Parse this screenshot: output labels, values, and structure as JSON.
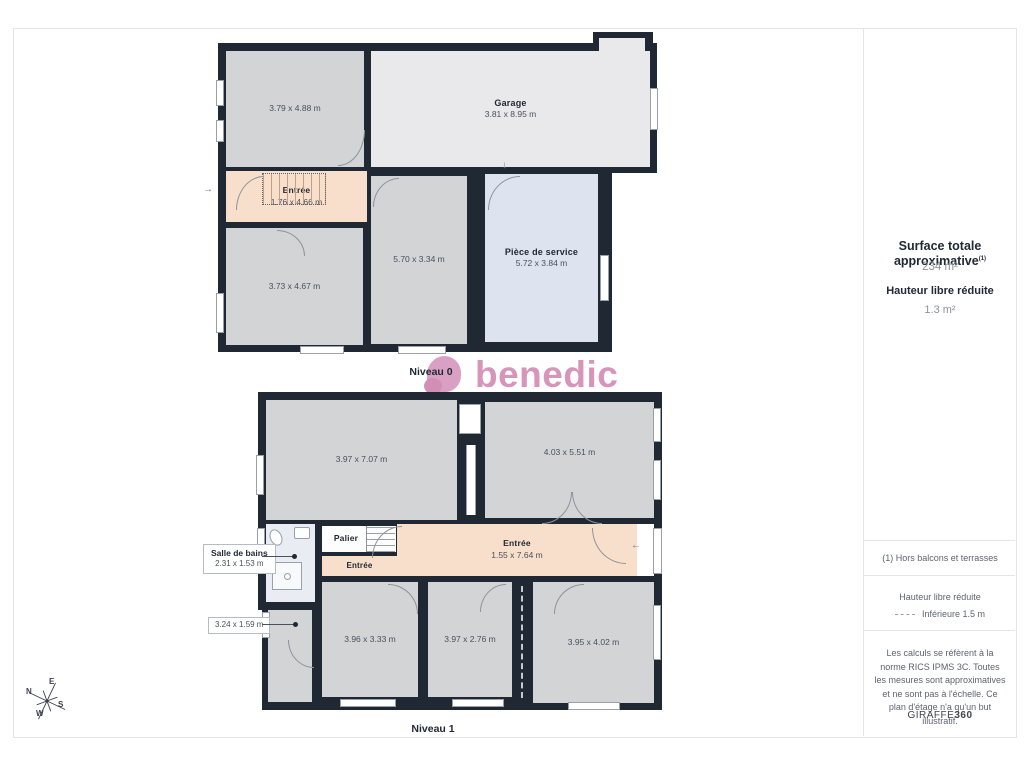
{
  "plans": {
    "niveau0": {
      "title": "Niveau 0",
      "rooms": [
        {
          "dims": "3.79 x 4.88 m"
        },
        {
          "name": "Garage",
          "dims": "3.81 x 8.95 m"
        },
        {
          "name": "Entrée",
          "dims": "1.76 x 4.66 m"
        },
        {
          "dims": "3.73 x 4.67 m"
        },
        {
          "dims": "5.70 x 3.34 m"
        },
        {
          "name": "Pièce de service",
          "dims": "5.72 x 3.84 m"
        }
      ]
    },
    "niveau1": {
      "title": "Niveau 1",
      "rooms": [
        {
          "dims": "3.97 x 7.07 m"
        },
        {
          "dims": "4.03 x 5.51 m"
        },
        {
          "name": "Palier"
        },
        {
          "name": "Entrée"
        },
        {
          "name": "Entrée",
          "dims": "1.55 x 7.64 m"
        },
        {
          "dims": "3.96 x 3.33 m"
        },
        {
          "dims": "3.97 x 2.76 m"
        },
        {
          "dims": "3.95 x 4.02 m"
        }
      ],
      "callouts": [
        {
          "name": "Salle de bains",
          "dims": "2.31 x 1.53 m"
        },
        {
          "dims": "3.24 x 1.59 m"
        }
      ]
    }
  },
  "logo": {
    "text": "benedic"
  },
  "compass": {
    "n": "N",
    "e": "E",
    "s": "S",
    "w": "W"
  },
  "icons": {
    "arrow_right": "→",
    "arrow_down": "↓",
    "arrow_left": "←"
  },
  "sidebar": {
    "surface_title": "Surface totale approximative",
    "surface_sup": "(1)",
    "surface_value": "234 m²",
    "height_title": "Hauteur libre réduite",
    "height_value": "1.3 m²",
    "note": "(1) Hors balcons et terrasses",
    "legend_title": "Hauteur libre réduite",
    "legend_value": "Inférieure 1.5 m",
    "disclaimer": "Les calculs se réfèrent à la norme RICS IPMS 3C. Toutes les mesures sont approximatives et ne sont pas à l'échelle. Ce plan d'étage n'a qu'un but illustratif.",
    "brand": "GIRAFFE",
    "brand_suffix": "360"
  },
  "colors": {
    "wall": "#1f2833",
    "room_gray": "#d2d4d6",
    "garage_gray": "#e9e9eb",
    "entry_peach": "#f8dfcb",
    "service_blue": "#dee4ef",
    "bath_blue": "#e9edf3",
    "brand_pink": "#d795ba"
  }
}
